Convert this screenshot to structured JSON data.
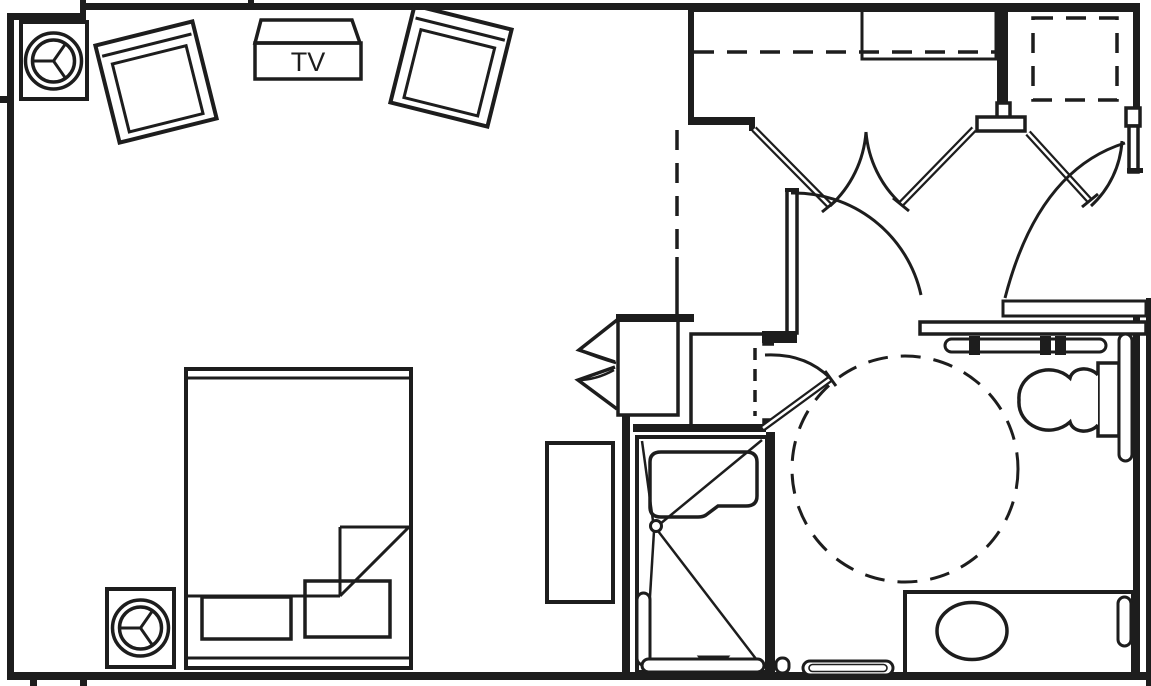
{
  "title": "Accessible guest room floor plan",
  "labels": {
    "tv": "TV"
  },
  "colors": {
    "ink": "#1d1d1d",
    "bg": "#ffffff"
  },
  "rooms": [
    {
      "name": "bedroom-living-area"
    },
    {
      "name": "entry-hall"
    },
    {
      "name": "bathroom"
    }
  ],
  "fixtures": [
    "round-table",
    "armchair",
    "tv-cabinet",
    "bed",
    "dresser",
    "bifold-closet",
    "linen-closet",
    "closet-rod",
    "closet-shelf",
    "shelf-dashed",
    "roll-in-shower",
    "shower-seat",
    "shower-drain",
    "shower-controls-triangle",
    "grab-bar",
    "toilet",
    "vanity-counter",
    "sink",
    "towel-bar",
    "hall-counter",
    "turning-circle",
    "door-swing",
    "door-leaf"
  ]
}
